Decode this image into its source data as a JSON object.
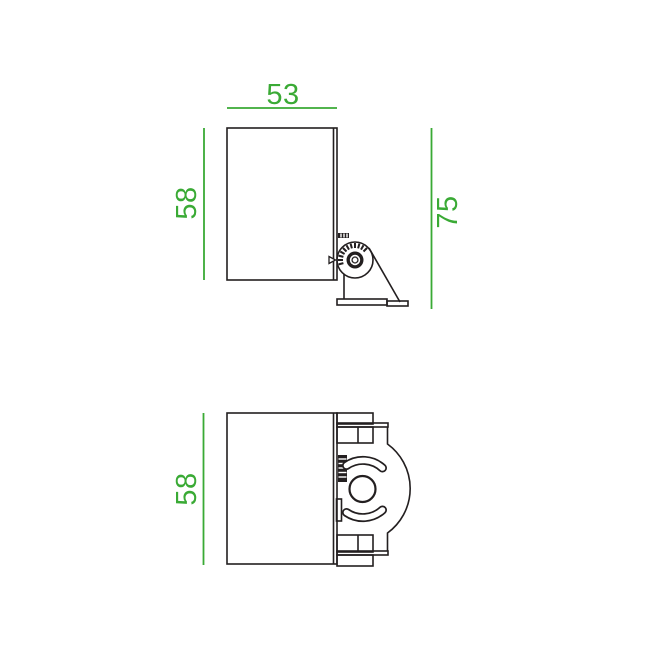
{
  "colors": {
    "dimension_green": "#3aaa35",
    "outline_dark": "#231f20",
    "background": "#ffffff"
  },
  "dimensions": {
    "side_view": {
      "width": "53",
      "body_height": "58",
      "overall_height": "75"
    },
    "top_view": {
      "body_depth": "58"
    }
  }
}
